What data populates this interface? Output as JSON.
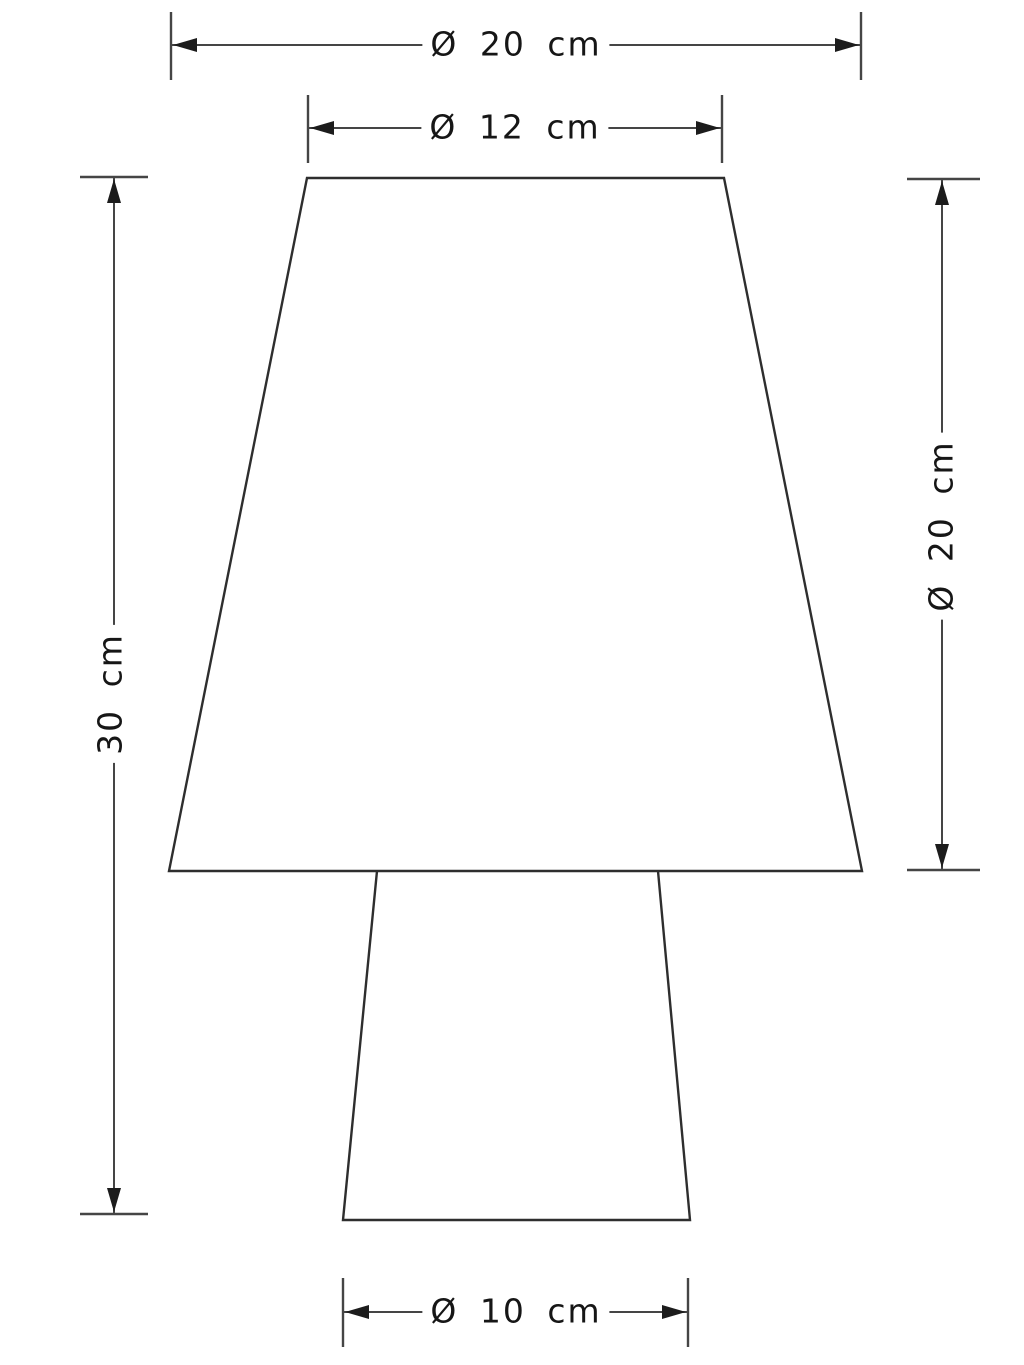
{
  "drawing": {
    "dimensions": {
      "outer_diameter": {
        "label": "Ø 20 cm",
        "value": 20,
        "unit": "cm"
      },
      "shade_top_diameter": {
        "label": "Ø 12 cm",
        "value": 12,
        "unit": "cm"
      },
      "total_height": {
        "label": "30 cm",
        "value": 30,
        "unit": "cm"
      },
      "shade_height": {
        "label": "Ø 20 cm",
        "value": 20,
        "unit": "cm"
      },
      "base_diameter": {
        "label": "Ø 10 cm",
        "value": 10,
        "unit": "cm"
      }
    },
    "colors": {
      "background": "#ffffff",
      "outline": "#2e2e2e",
      "dimension_line": "#454545",
      "arrow": "#1c1c1c",
      "text": "#161616"
    }
  }
}
